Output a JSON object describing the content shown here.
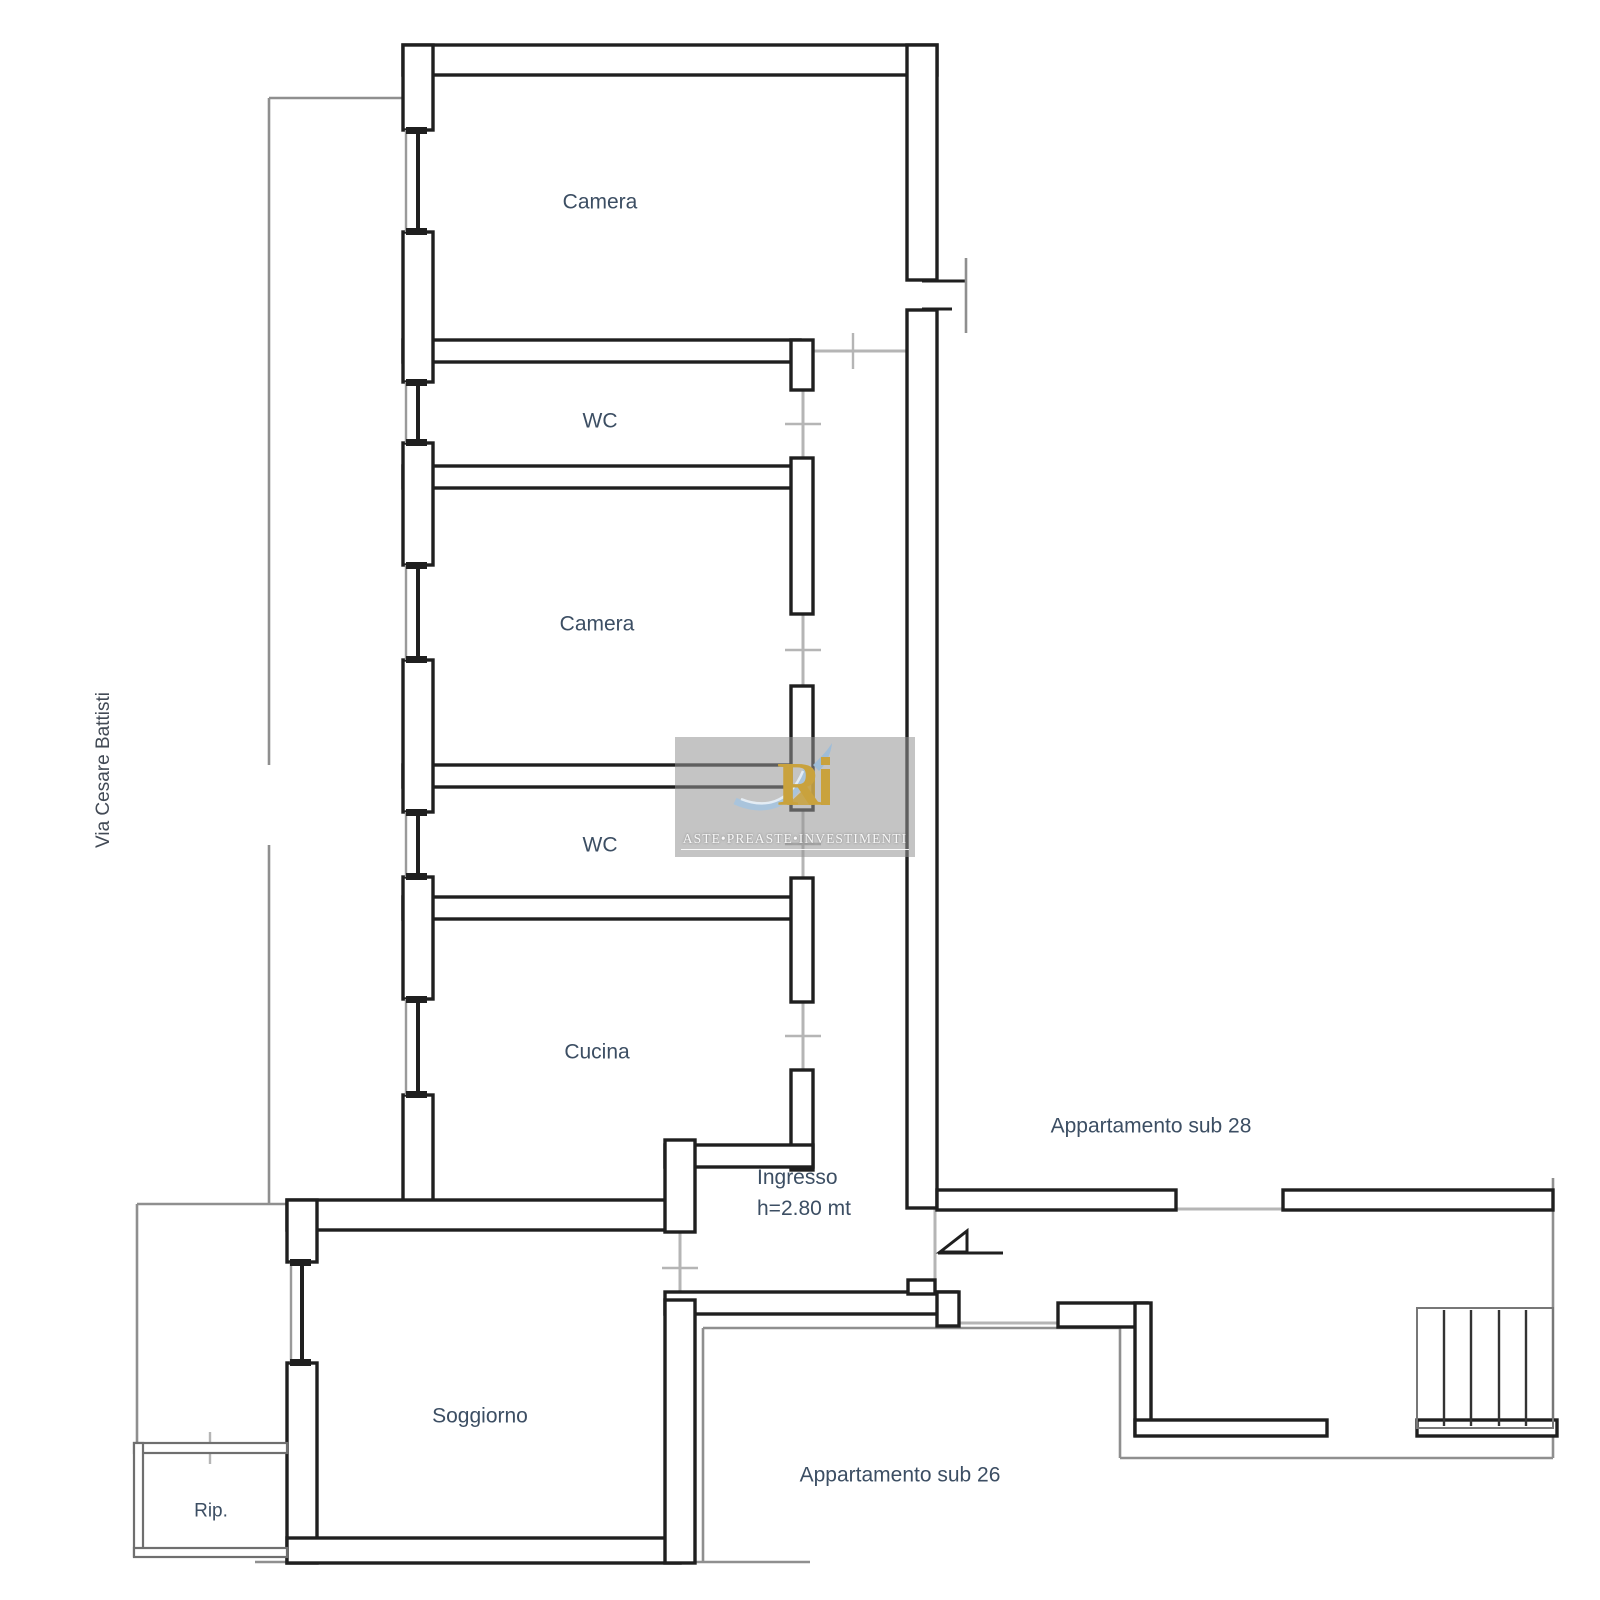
{
  "labels": {
    "camera_top": "Camera",
    "wc_top": "WC",
    "camera_mid": "Camera",
    "wc_mid": "WC",
    "cucina": "Cucina",
    "ingresso": "Ingresso",
    "ingresso_height": "h=2.80 mt",
    "soggiorno": "Soggiorno",
    "rip": "Rip.",
    "apartment_28": "Appartamento sub 28",
    "apartment_26": "Appartamento sub 26",
    "street": "Via Cesare Battisti"
  },
  "watermark": {
    "brand_text": "ASTE•PREASTE•INVESTIMENTI",
    "logo_monogram": "R"
  },
  "colors": {
    "wall": "#1f1f1f",
    "label_text": "#3c4e63",
    "boundary_line": "#8f8f8f",
    "door_line": "#b5b5b5",
    "watermark_gold": "#c9a23d",
    "watermark_blue": "#8fb4d8",
    "watermark_bg": "rgba(148,148,148,0.55)"
  }
}
